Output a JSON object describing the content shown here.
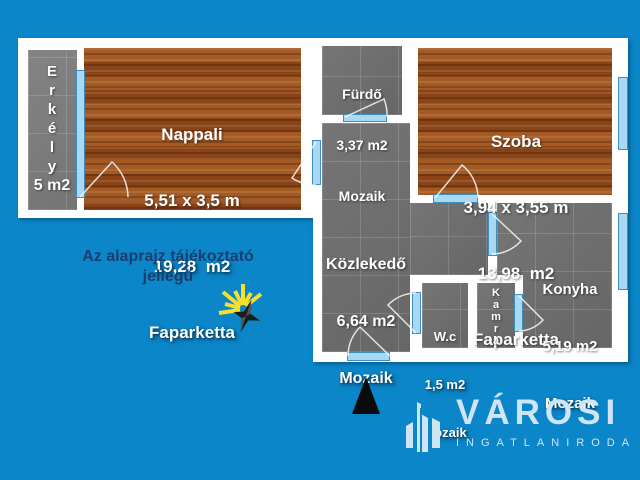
{
  "notice": {
    "text": "Az alaprajz tájékoztató\njellegű"
  },
  "rooms": {
    "erkely": {
      "name_vertical": "E\nr\nk\né\nl\ny",
      "area": "5 m2"
    },
    "nappali": {
      "name": "Nappali",
      "dimensions": "5,51 x 3,5 m",
      "area": "19,28  m2",
      "floor": "Faparketta"
    },
    "furdo": {
      "name": "Fürdő",
      "area": "3,37 m2",
      "floor": "Mozaik"
    },
    "szoba": {
      "name": "Szoba",
      "dimensions": "3,94 x 3,55 m",
      "area": "13,98  m2",
      "floor": "Faparketta"
    },
    "kozlekedo": {
      "name": "Közlekedő",
      "area": "6,64 m2",
      "floor": "Mozaik"
    },
    "wc": {
      "name": "W.c",
      "area": "1,5 m2",
      "floor": "Mozaik"
    },
    "kamra": {
      "name_vertical": "K\na\nm\nr\na"
    },
    "konyha": {
      "name": "Konyha",
      "area": "5,19 m2",
      "floor": "Mozaik"
    }
  },
  "branding": {
    "name": "VÁROSI",
    "subtitle": "INGATLANIRODA"
  },
  "icons": {
    "sun": "sun-compass-icon",
    "north": "north-arrow-icon",
    "logo": "city-buildings-icon"
  },
  "colors": {
    "background": "#0b86c8",
    "notice_text": "#1c3e6f",
    "room_text": "#ffffff",
    "wood_floor": "#9a5120",
    "tile_floor": "#6e6e6e",
    "window": "#a9d9f2",
    "logo_text": "#cfe4f5",
    "north_arrow": "#0b0b0b"
  }
}
